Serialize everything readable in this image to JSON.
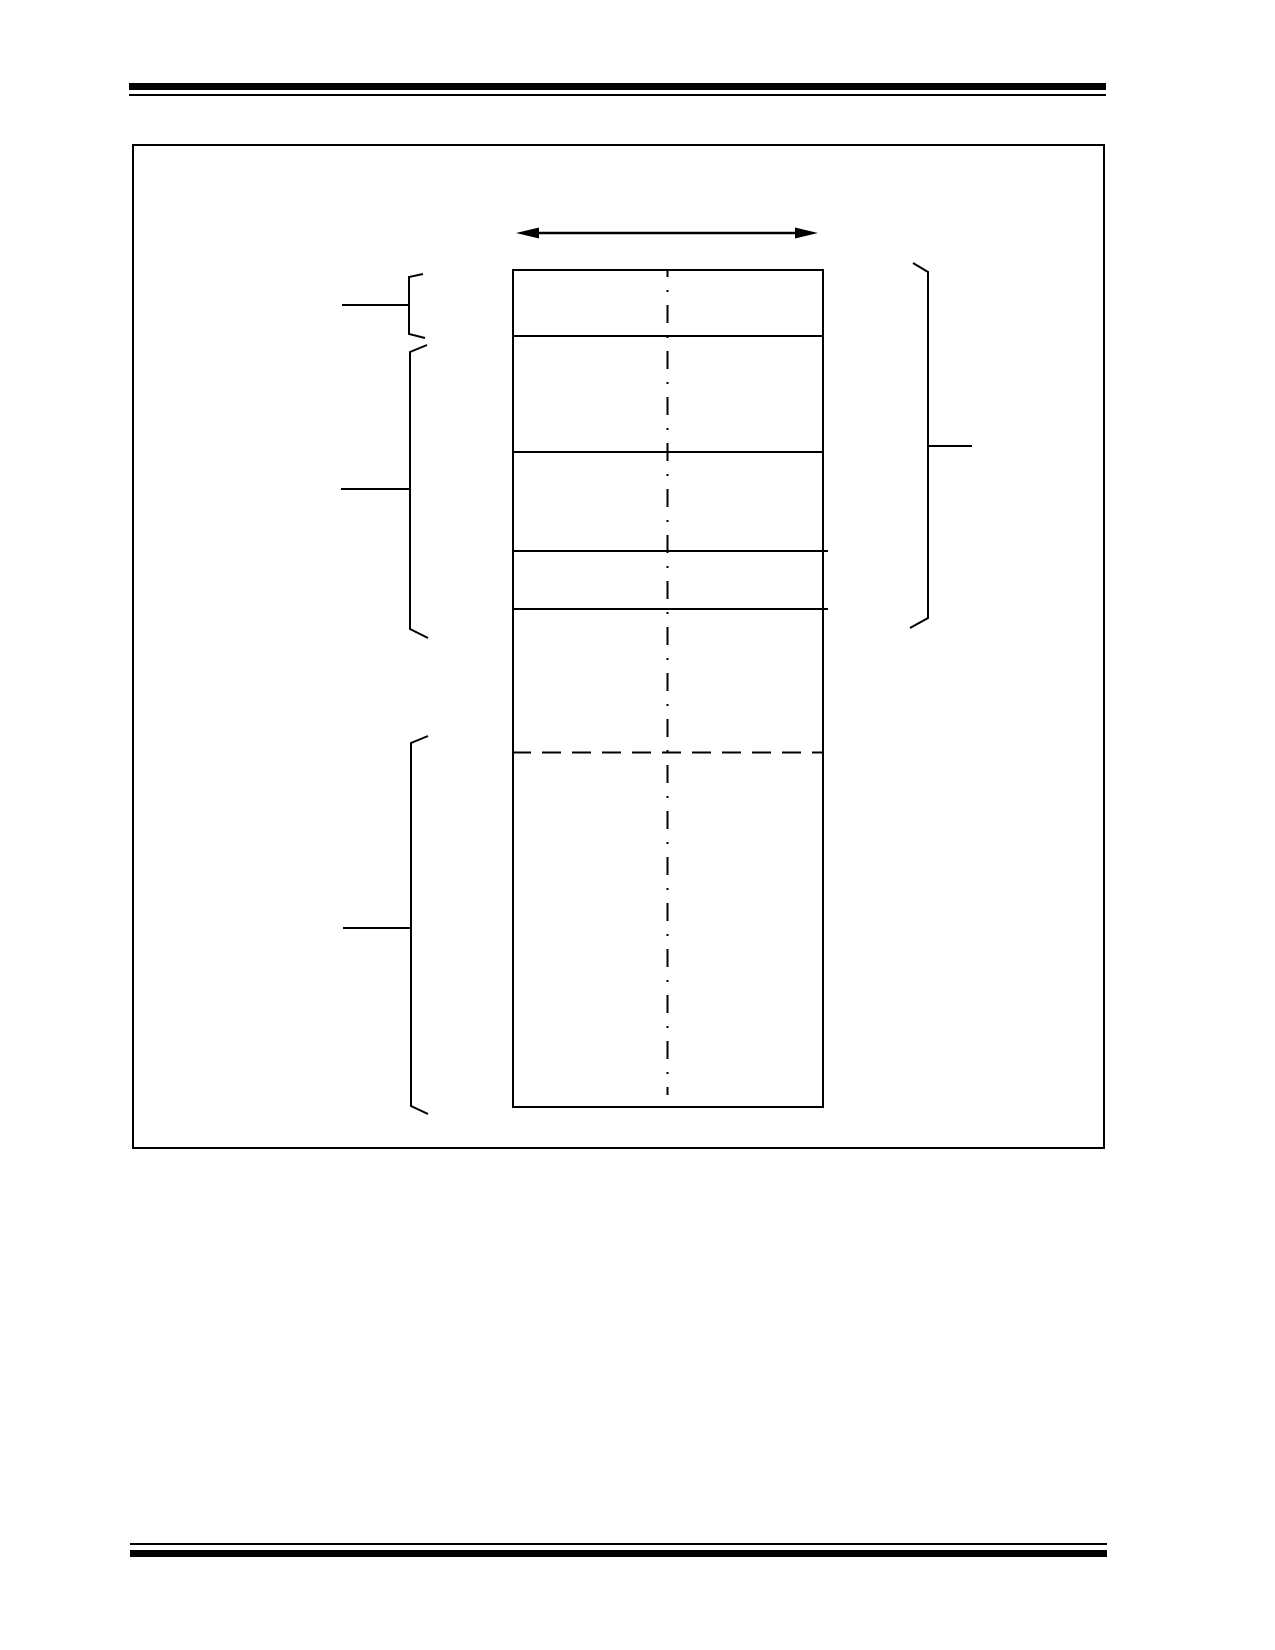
{
  "page": {
    "background_color": "#ffffff",
    "ink_color": "#000000",
    "visible_text": []
  },
  "header": {
    "rule_style": "double",
    "thick_rule_px": 7,
    "thin_rule_px": 2
  },
  "footer": {
    "rule_style": "double",
    "thick_rule_px": 7,
    "thin_rule_px": 2
  },
  "figure": {
    "kind": "blank-memory-map-diagram",
    "frame_border_px": 2,
    "icons": [
      {
        "name": "double-arrow-icon",
        "meaning": "horizontal width span",
        "glyph": "↔"
      }
    ],
    "memory_map": {
      "row_count": 6,
      "solid_divider_count": 4,
      "dashed_divider_count": 1,
      "center_line_style": "dash-dot",
      "left_bracket_count": 3,
      "right_bracket_count": 1,
      "leader_line_count": 4
    }
  }
}
